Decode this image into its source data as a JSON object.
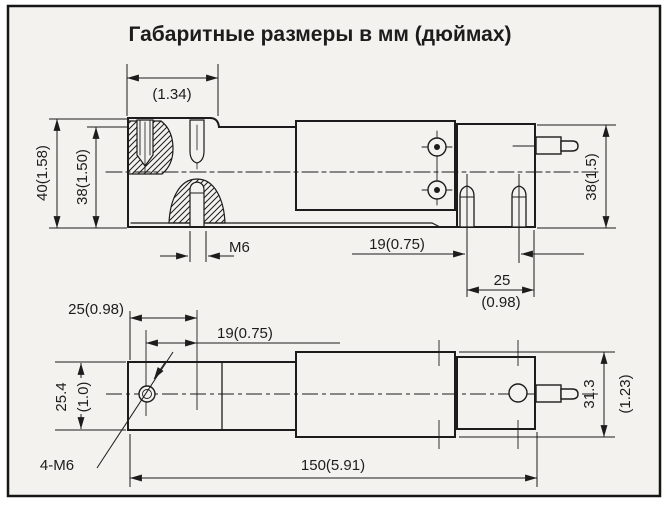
{
  "title": "Габаритные размеры в мм (дюймах)",
  "side_view": {
    "dim_top_width": "(1.34)",
    "dim_height_overall": "40(1.58)",
    "dim_height_step": "38(1.50)",
    "dim_height_right": "38(1.5)",
    "thread_label": "M6",
    "dim_stud_spacing": "19(0.75)",
    "dim_stud_to_end": "25",
    "dim_stud_to_end_in": "(0.98)"
  },
  "plan_view": {
    "dim_edge_to_hole": "25(0.98)",
    "dim_hole_spacing": "19(0.75)",
    "dim_width": "25.4",
    "dim_width_in": "(1.0)",
    "holes_label": "4-M6",
    "dim_length": "150(5.91)",
    "dim_width_right": "31.3",
    "dim_width_right_in": "(1.23)"
  },
  "colors": {
    "ink": "#1c1c1c",
    "paper": "#f4f2ee"
  }
}
